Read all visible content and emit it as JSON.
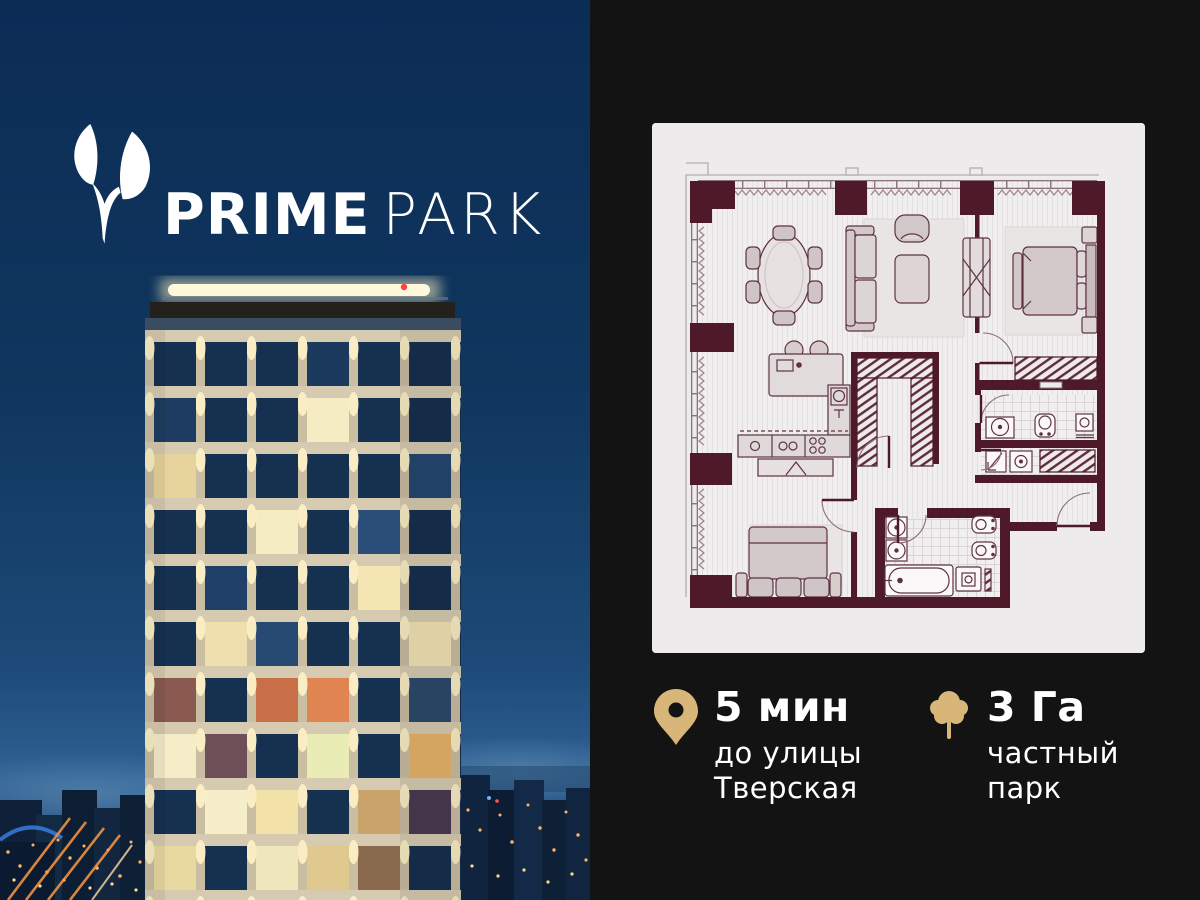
{
  "brand": {
    "prime": "PRIME",
    "park": "PARK",
    "logo_icon": "sprout-leaves-icon"
  },
  "stats": [
    {
      "icon": "location-pin-icon",
      "value": "5 мин",
      "line1": "до улицы",
      "line2": "Тверская"
    },
    {
      "icon": "tree-icon",
      "value": "3 Га",
      "line1": "частный",
      "line2": "парк"
    }
  ],
  "floor_plan_card": {
    "content": "architectural floor plan, no text labels"
  },
  "colors": {
    "panel_bg": "#131313",
    "gold_accent": "#D8B67A",
    "plan_paper": "#EDEBEB",
    "plan_wall": "#4E1A2A",
    "logo_white": "#FFFFFF",
    "sky_top": "#0B2C55",
    "city_light": "#FFB264"
  }
}
